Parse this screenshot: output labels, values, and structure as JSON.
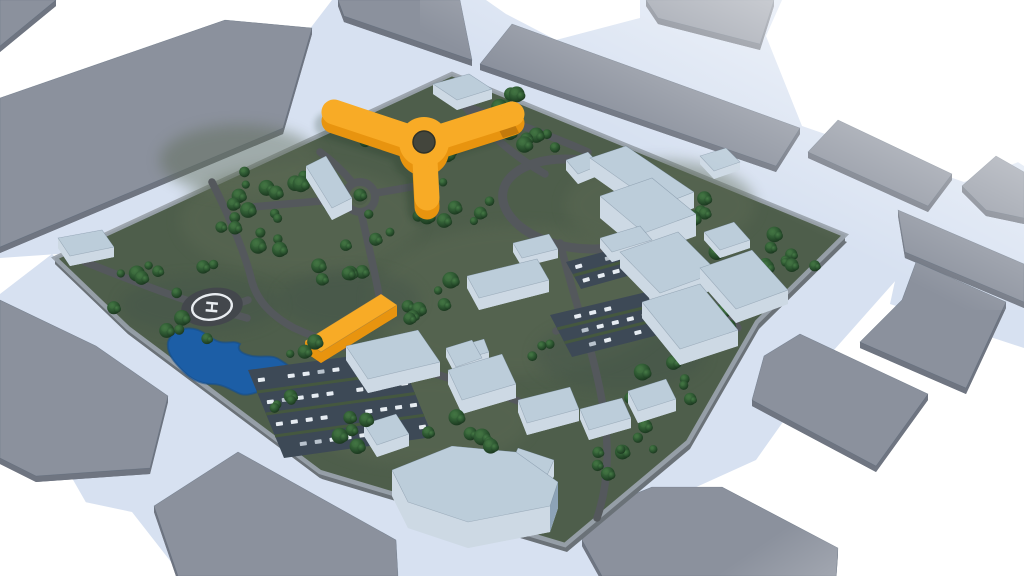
{
  "scene": {
    "title": "3D campus site model render",
    "background": "#ffffff",
    "helipad": {
      "label": "H"
    },
    "palette": {
      "street": "#d7e1f1",
      "street_deep": "#c8d5e9",
      "block_top": "#8b919d",
      "block_side": "#6f7581",
      "campus_green": "#4e5e4b",
      "campus_green_light": "#5d6b54",
      "campus_green_dark": "#435349",
      "plateau_side": "#6b7278",
      "curb": "#99a1ab",
      "road": "#54585c",
      "tree_dark": "#1c3a1f",
      "tree_mid": "#2c5530",
      "tree_light": "#3f7040",
      "water": "#1c5ea6",
      "water_deep": "#164e8c",
      "building_top": "#bccdda",
      "building_front": "#cdd9e4",
      "building_right": "#8da3b7",
      "building_left": "#a2b5c6",
      "accent_top": "#f8ab26",
      "accent_front": "#e8940f",
      "accent_right": "#c37a0c",
      "accent_left": "#d8860e",
      "accent_hole": "#43453c",
      "parking_lot": "#3d4956",
      "parking_strip": "#45583f",
      "car": "#e6ecf2",
      "car_alt": "#b9c3cd",
      "helipad_pad": "#43474c",
      "helipad_marking": "#e9edf1"
    },
    "landmarks": [
      {
        "id": "tri-arm-building",
        "desc": "orange Y-shaped landmark building with circular atrium"
      },
      {
        "id": "accent-bar-building",
        "desc": "orange bar building"
      },
      {
        "id": "hospital-complex",
        "desc": "pale blue building complex"
      },
      {
        "id": "helipad",
        "desc": "helipad with H marking"
      },
      {
        "id": "pond",
        "desc": "irregular blue pond"
      },
      {
        "id": "parking-lot",
        "desc": "parking lots with parked cars"
      },
      {
        "id": "roundabout",
        "desc": "small roundabout"
      },
      {
        "id": "ring-road",
        "desc": "large circular ring road"
      },
      {
        "id": "city-block",
        "desc": "surrounding gray city blocks"
      }
    ],
    "counts": {
      "city_blocks": 13,
      "campus_buildings": 28,
      "parking_lots": 3,
      "helipads": 1,
      "ponds": 1
    }
  }
}
